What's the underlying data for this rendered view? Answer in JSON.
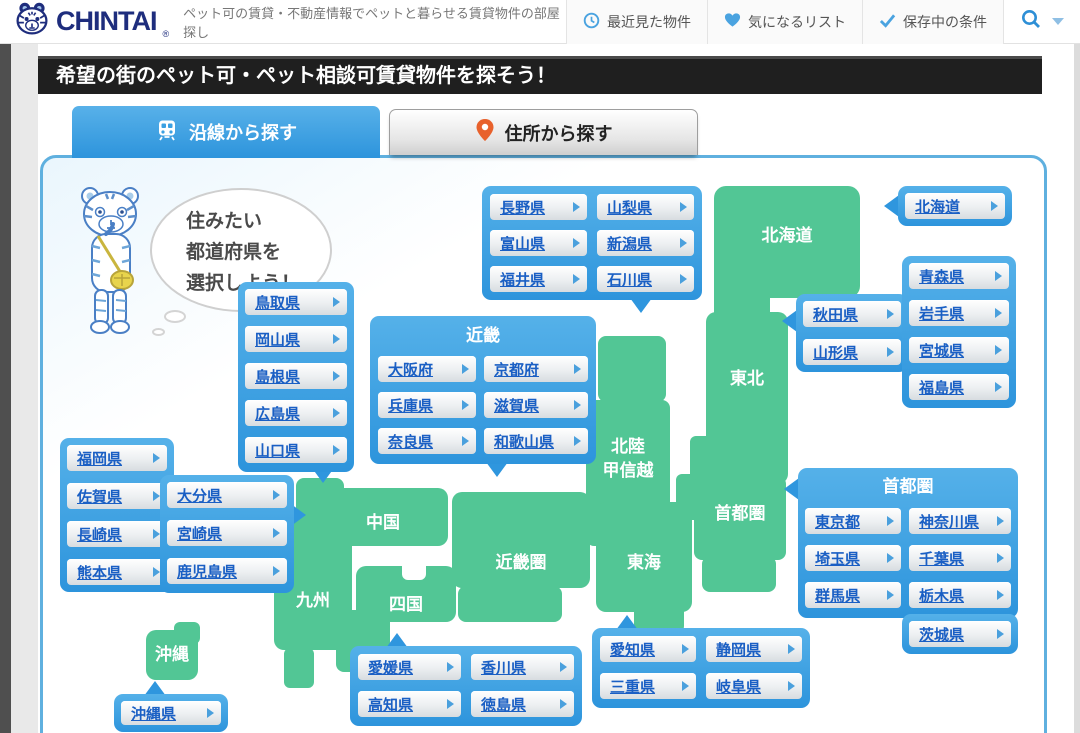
{
  "colors": {
    "accent_blue": "#2f96de",
    "map_green": "#52c695",
    "link_blue": "#1a5fc4",
    "banner_bg": "#1f1f1f",
    "logo_navy": "#1e2d7d",
    "pin_orange": "#e8612c"
  },
  "header": {
    "logo_text": "CHINTAI",
    "logo_mark": "®",
    "tagline": "ペット可の賃貸・不動産情報でペットと暮らせる賃貸物件の部屋探し",
    "nav": [
      {
        "label": "最近見た物件",
        "icon": "clock-icon"
      },
      {
        "label": "気になるリスト",
        "icon": "heart-icon"
      },
      {
        "label": "保存中の条件",
        "icon": "check-icon"
      }
    ],
    "search_icon": "magnifier",
    "caret_icon": "triangle-down"
  },
  "banner": {
    "title": "希望の街のペット可・ペット相談可賃貸物件を探そう！"
  },
  "tabs": [
    {
      "label": "沿線から探す",
      "icon": "train-icon",
      "active": true
    },
    {
      "label": "住所から探す",
      "icon": "map-pin-icon",
      "active": false
    }
  ],
  "mascot": {
    "speech_line1": "住みたい",
    "speech_line2": "都道府県を",
    "speech_line3": "選択しよう！"
  },
  "map": {
    "region_labels": {
      "hokkaido": "北海道",
      "tohoku": "東北",
      "hokuriku_line1": "北陸",
      "hokuriku_line2": "甲信越",
      "shutoken": "首都圏",
      "chugoku": "中国",
      "kinkiken": "近畿圏",
      "tokai": "東海",
      "kyushu": "九州",
      "shikoku": "四国",
      "okinawa": "沖縄"
    }
  },
  "groups": {
    "koshinetsu": {
      "buttons": [
        "長野県",
        "山梨県",
        "富山県",
        "新潟県",
        "福井県",
        "石川県"
      ]
    },
    "hokkaido": {
      "buttons": [
        "北海道"
      ]
    },
    "tohoku_main": {
      "buttons": [
        "青森県",
        "岩手県",
        "宮城県",
        "福島県"
      ]
    },
    "tohoku_side": {
      "buttons": [
        "秋田県",
        "山形県"
      ]
    },
    "chugoku": {
      "buttons": [
        "鳥取県",
        "岡山県",
        "島根県",
        "広島県",
        "山口県"
      ]
    },
    "kinki": {
      "header": "近畿",
      "buttons": [
        "大阪府",
        "京都府",
        "兵庫県",
        "滋賀県",
        "奈良県",
        "和歌山県"
      ]
    },
    "kyushu_left": {
      "buttons": [
        "福岡県",
        "佐賀県",
        "長崎県",
        "熊本県"
      ]
    },
    "kyushu_right": {
      "buttons": [
        "大分県",
        "宮崎県",
        "鹿児島県"
      ]
    },
    "okinawa": {
      "buttons": [
        "沖縄県"
      ]
    },
    "shikoku": {
      "buttons": [
        "愛媛県",
        "香川県",
        "高知県",
        "徳島県"
      ]
    },
    "tokai": {
      "buttons": [
        "愛知県",
        "静岡県",
        "三重県",
        "岐阜県"
      ]
    },
    "shutoken": {
      "header": "首都圏",
      "buttons": [
        "東京都",
        "神奈川県",
        "埼玉県",
        "千葉県",
        "群馬県",
        "栃木県",
        "茨城県"
      ]
    }
  }
}
